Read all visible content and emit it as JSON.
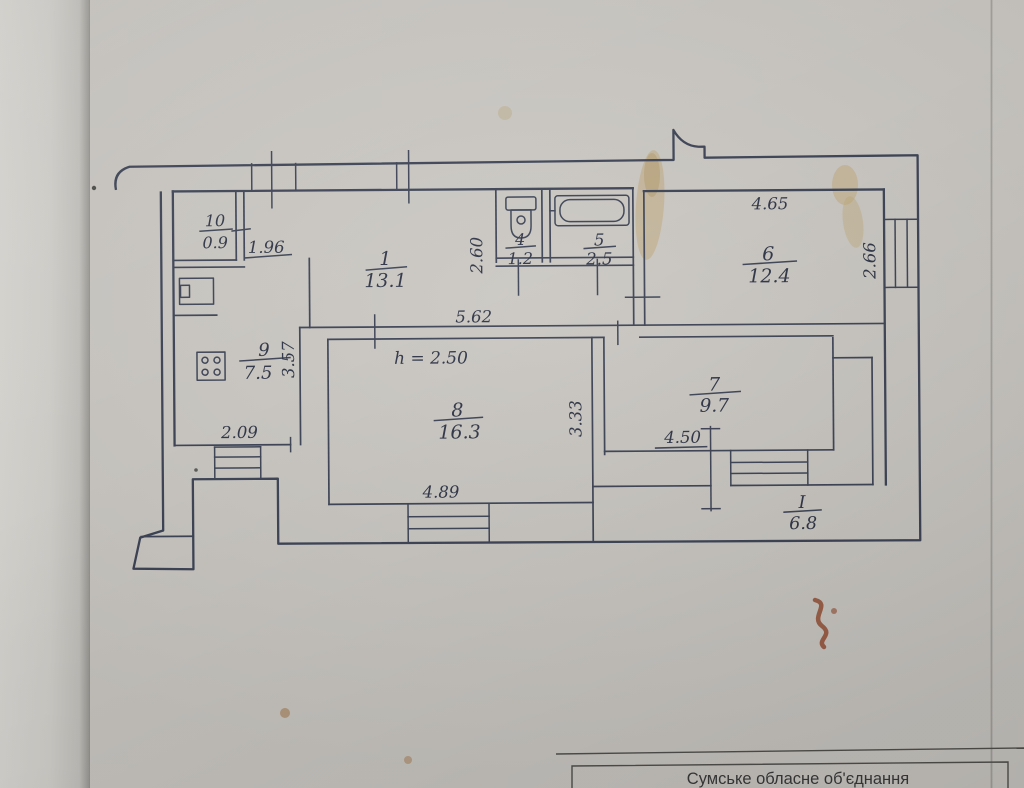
{
  "page": {
    "paper_color": "#cac7c2",
    "ink_color": "#3b4254",
    "handwriting_color": "#2d3345",
    "stain_color": "#b89858",
    "stain_red_color": "#8d4a2c"
  },
  "rooms": {
    "r10": {
      "num": "10",
      "area": "0.9"
    },
    "r1": {
      "num": "1",
      "area": "13.1"
    },
    "r4": {
      "num": "4",
      "area": "1.2"
    },
    "r5": {
      "num": "5",
      "area": "2.5"
    },
    "r6": {
      "num": "6",
      "area": "12.4"
    },
    "r7": {
      "num": "7",
      "area": "9.7"
    },
    "r8": {
      "num": "8",
      "area": "16.3"
    },
    "r9": {
      "num": "9",
      "area": "7.5"
    },
    "loggia": {
      "num": "I",
      "area": "6.8"
    }
  },
  "dimensions": {
    "d196": "1.96",
    "d209": "2.09",
    "d260": "2.60",
    "d266": "2.66",
    "d333": "3.33",
    "d357": "3.57",
    "d450": "4.50",
    "d465": "4.65",
    "d489": "4.89",
    "d562": "5.62",
    "height_note": "h = 2.50"
  },
  "icons": {
    "toilet": "toilet-top-view",
    "bathtub": "bathtub-top-view",
    "stove": "stove-four-burners",
    "vent": "duct-box"
  },
  "title_block": {
    "text": "Сумське обласне об'єднання"
  }
}
